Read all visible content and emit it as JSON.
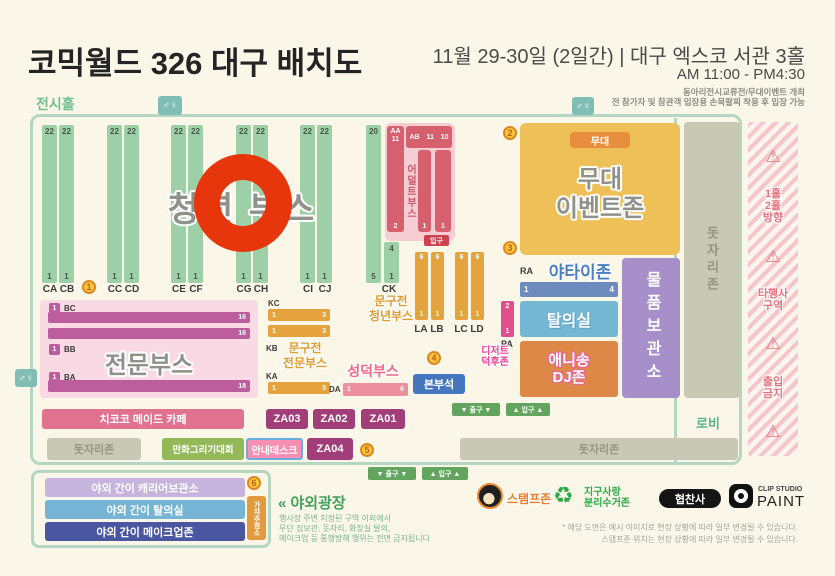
{
  "header": {
    "title": "코믹월드 326 대구 배치도",
    "date_venue": "11월 29-30일 (2일간) | 대구 엑스코 서관 3홀",
    "time": "AM 11:00 - PM4:30",
    "note1": "동아리전시교류전/무대이벤트 개최",
    "note2": "전 참가자 및 참관객 입장용 손목팔찌 착용 후 입장 가능"
  },
  "hall_label": "전시홀",
  "icons": {
    "restroom": "♂♀",
    "warning": "⚠",
    "recycle": "♻"
  },
  "colors": {
    "accent_green": "#9ed0a8",
    "accent_orange": "#e5a33e",
    "stage_yellow": "#eec158",
    "booth_pink": "#bc5d9e",
    "hazard_pink": "#e4737c",
    "highlight_red": "#e7350c"
  },
  "youth": {
    "label": "청년 부스",
    "strips": [
      {
        "id": "CA",
        "top": "22",
        "bottom": "1"
      },
      {
        "id": "CB",
        "top": "22",
        "bottom": "1"
      },
      {
        "id": "CC",
        "top": "22",
        "bottom": "1"
      },
      {
        "id": "CD",
        "top": "22",
        "bottom": "1"
      },
      {
        "id": "CE",
        "top": "22",
        "bottom": "1"
      },
      {
        "id": "CF",
        "top": "22",
        "bottom": "1"
      },
      {
        "id": "CG",
        "top": "22",
        "bottom": "1"
      },
      {
        "id": "CH",
        "top": "22",
        "bottom": "1"
      },
      {
        "id": "CI",
        "top": "22",
        "bottom": "1"
      },
      {
        "id": "CJ",
        "top": "22",
        "bottom": "1"
      }
    ],
    "ck_label": "CK",
    "ck_tall": {
      "top": "20",
      "bottom": "5"
    },
    "ck_short": {
      "top": "4",
      "bottom": "1"
    }
  },
  "adult": {
    "label": "어덜트부스",
    "aa": "AA",
    "aa_num": "11",
    "ab": "AB",
    "ab_n1": "11",
    "ab_n2": "10",
    "left_bottom": "2",
    "mid_bottom": "1",
    "right_bottom": "1",
    "entrance": "입구"
  },
  "stage": {
    "badge": "무대",
    "line1": "무대",
    "line2": "이벤트존"
  },
  "yatai": {
    "label": "야타이존",
    "row": "RA",
    "first": "1",
    "last": "4"
  },
  "dressing": "탈의실",
  "anisong": {
    "line1": "애니송",
    "line2": "DJ존"
  },
  "storage": "물품보관소",
  "pa": {
    "id": "PA",
    "top": "2",
    "bottom": "1"
  },
  "dessert": {
    "line1": "디저트",
    "line2": "덕후존"
  },
  "st_youth": {
    "line1": "문구전",
    "line2": "청년부스",
    "strips": [
      {
        "id": "LA",
        "top": "6",
        "bottom": "1"
      },
      {
        "id": "LB",
        "top": "6",
        "bottom": "1"
      },
      {
        "id": "LC",
        "top": "6",
        "bottom": "1"
      },
      {
        "id": "LD",
        "top": "6",
        "bottom": "1"
      }
    ]
  },
  "pro": {
    "label": "전문부스",
    "rows": [
      {
        "id": "BC",
        "sq": "1",
        "last": "16"
      },
      {
        "id": "BB",
        "sq": "1",
        "last": "16"
      },
      {
        "id": "BA",
        "sq": "1",
        "last": "18"
      }
    ]
  },
  "st_pro": {
    "line1": "문구전",
    "line2": "전문부스",
    "kc": "KC",
    "kb": "KB",
    "ka": "KA",
    "bars": [
      {
        "first": "1",
        "last": "3"
      },
      {
        "first": "1",
        "last": "3"
      },
      {
        "first": "1",
        "last": "3"
      }
    ]
  },
  "seongdeok": {
    "label": "성덕부스",
    "row": "DA",
    "first": "1",
    "last": "6"
  },
  "hq": "본부석",
  "maid_cafe": "치코코 메이드 카페",
  "za": {
    "z3": "ZA03",
    "z2": "ZA02",
    "z1": "ZA01",
    "z4": "ZA04"
  },
  "mat": "돗자리존",
  "contest": "만화그리기대회",
  "info_desk": "안내데스크",
  "lobby": "로비",
  "gates": {
    "exit": "▼ 출구 ▼",
    "entry": "▲ 입구 ▲"
  },
  "hazard": {
    "dir1": "1홀",
    "dir2": "2홀",
    "dir3": "방향",
    "other1": "타행사",
    "other2": "구역",
    "no1": "출입",
    "no2": "금지"
  },
  "outdoor": {
    "row1": "야외 간이 캐리어보관소",
    "row2": "야외 간이 탈의실",
    "row3": "야외 간이 메이크업존",
    "gacha": "가챠추첨소",
    "plaza": "« 야외광장",
    "info1": "행사장 주변 지정된 구역 이외에서",
    "info2": "무단 짐보관, 돗자리, 화장실 탈의,",
    "info3": "메이크업 등 통행방해 행위는 전면 금지됩니다"
  },
  "legend": {
    "stamp": "스탬프존",
    "recycle1": "지구사랑",
    "recycle2": "분리수거존",
    "sponsor": "협찬사",
    "clip_top": "CLIP STUDIO",
    "clip_bottom": "PAINT"
  },
  "footnotes": {
    "line1": "* 해당 도면은 예시 이미지로 현장 상황에 따라 일부 변경될 수 있습니다.",
    "line2": "스탬프존 위치는 현장 상황에 따라 일부 변경될 수 있습니다."
  },
  "markers": {
    "m1": "1",
    "m2": "2",
    "m3": "3",
    "m4": "4",
    "m5": "5",
    "m6": "6"
  }
}
